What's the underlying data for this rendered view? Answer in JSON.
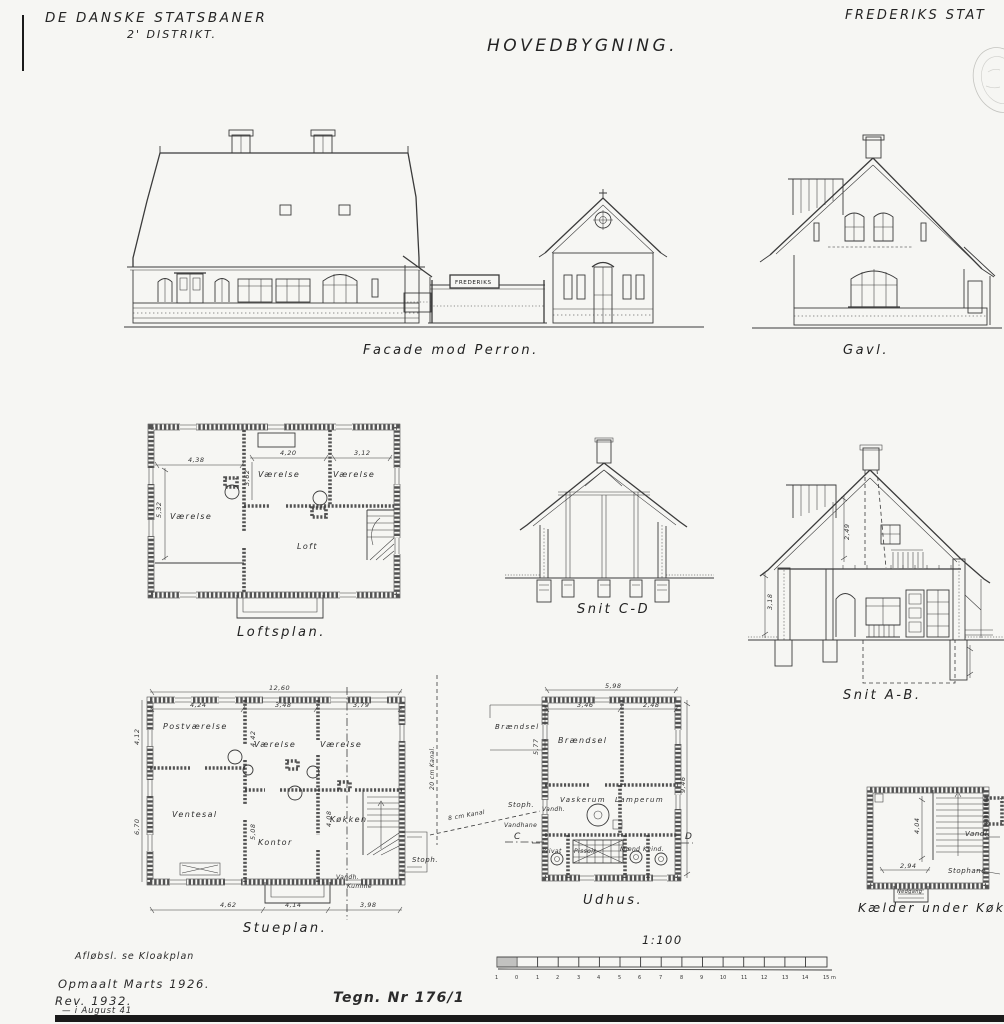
{
  "header": {
    "company": "DE DANSKE STATSBANER",
    "district": "2' DISTRIKT.",
    "title": "HOVEDBYGNING.",
    "station": "FREDERIKS STAT"
  },
  "facade": {
    "caption": "Facade mod Perron.",
    "sign": "FREDERIKS"
  },
  "gavl": {
    "caption": "Gavl."
  },
  "loftsplan": {
    "caption": "Loftsplan.",
    "rooms": {
      "left": "Værelse",
      "mid": "Værelse",
      "right": "Værelse",
      "loft": "Loft"
    },
    "dims": {
      "top_left": "4,38",
      "top_mid": "4,20",
      "top_right": "3,12",
      "left": "5,32",
      "mid": "3,62"
    }
  },
  "snit_cd": {
    "caption": "Snit C-D"
  },
  "snit_ab": {
    "caption": "Snit A-B.",
    "dims": {
      "upper": "2,49",
      "left": "3,18"
    }
  },
  "stueplan": {
    "caption": "Stueplan.",
    "rooms": {
      "postvaerelse": "Postværelse",
      "ventesal": "Ventesal",
      "vaerelse1": "Værelse",
      "vaerelse2": "Værelse",
      "kontor": "Kontor",
      "koekken": "Køkken"
    },
    "labels": {
      "vandh": "Vandh.",
      "kumme": "Kumme",
      "stoph": "Stoph."
    },
    "dims": {
      "total": "12,60",
      "t1": "4,24",
      "t2": "3,48",
      "t3": "3,79",
      "left1": "4,12",
      "left2": "6,70",
      "v1": "4,42",
      "v2": "5,08",
      "v3": "4,08",
      "b1": "4,62",
      "b2": "4,14",
      "b3": "3,98"
    }
  },
  "courtyard": {
    "braendsel": "Brændsel",
    "kanal8": "8 cm Kanal",
    "kanal20": "20 cm Kanal.",
    "stoph": "Stoph.",
    "vandhane": "Vandhane",
    "section_c": "C",
    "section_d": "D"
  },
  "udhus": {
    "caption": "Udhus.",
    "rooms": {
      "braendsel": "Brændsel",
      "vaskerum": "Vaskerum",
      "lamperum": "Lamperum",
      "privat": "Privat",
      "pissoir": "Pissoir",
      "maend": "Mænd",
      "kvind": "Kvind."
    },
    "labels": {
      "vandh": "Vandh."
    },
    "dims": {
      "top": "5,98",
      "t1": "3,46",
      "t2": "2,48",
      "left": "5,77",
      "right": "9,46"
    }
  },
  "kaelder": {
    "caption": "Kælder under Køkken.",
    "labels": {
      "vandl": "Vandl.",
      "stophane": "Stophane",
      "nedgang": "Nedgang"
    },
    "dims": {
      "w": "2,94",
      "h": "4,04"
    }
  },
  "scalebar": {
    "ratio": "1:100",
    "ticks": [
      "1",
      "0",
      "1",
      "2",
      "3",
      "4",
      "5",
      "6",
      "7",
      "8",
      "9",
      "10",
      "11",
      "12",
      "13",
      "14",
      "15 m"
    ]
  },
  "notes": {
    "afloeb": "Afløbsl. se Kloakplan",
    "opmaalt": "Opmaalt Marts 1926.",
    "rev": "Rev. 1932.",
    "rev2": "— i August 41",
    "tegn": "Tegn. Nr 176/1"
  }
}
